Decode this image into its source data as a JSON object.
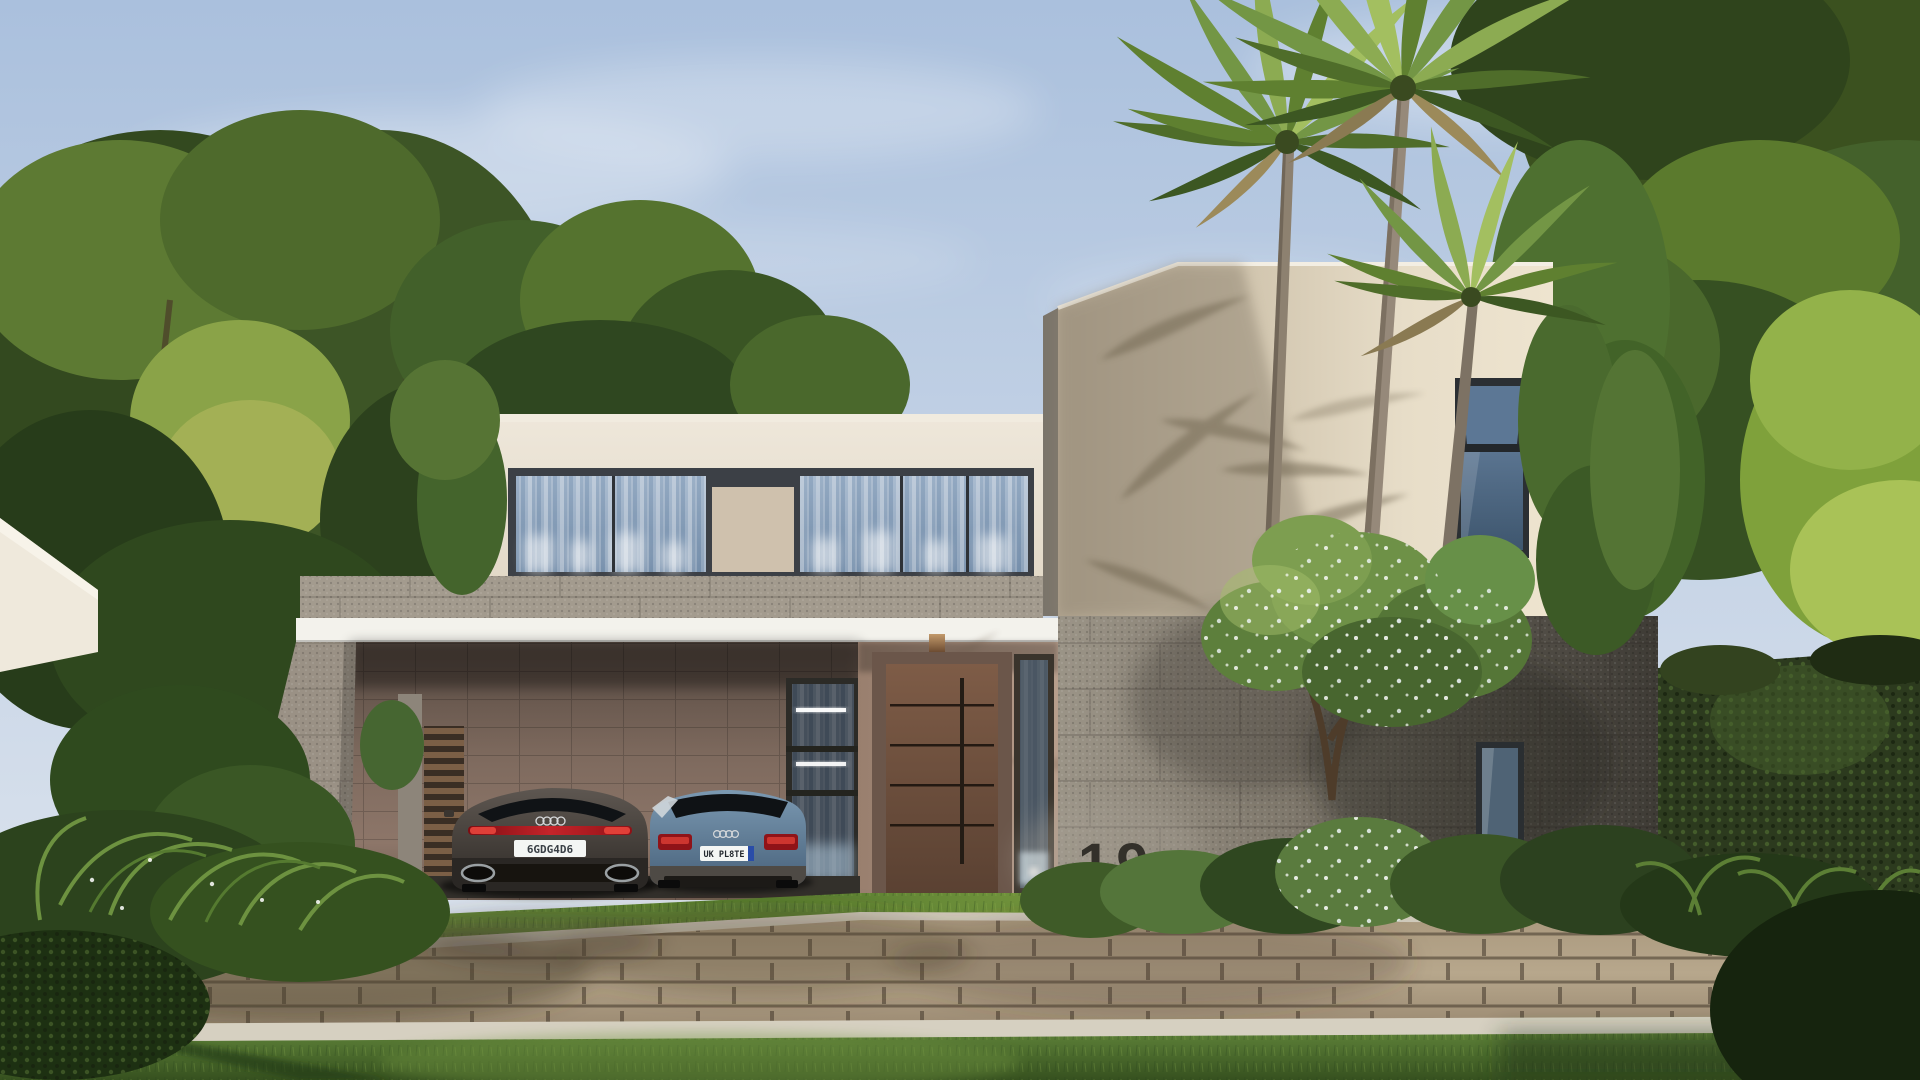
{
  "scene": {
    "setting": "Photorealistic exterior rendering of a modern two-storey villa with carport, palm trees and landscaped front yard",
    "elements": [
      "sky",
      "clouds",
      "background-trees",
      "neighbor-wall",
      "villa-upper-floor",
      "tower-volume",
      "white-fascia",
      "carport",
      "front-door",
      "entry-wall",
      "stone-wall",
      "house-number",
      "palm-trees",
      "flowering-tree",
      "ivy-boundary-wall",
      "shrubs",
      "ferns",
      "grass-strip",
      "paver-driveway",
      "curb",
      "front-lawn",
      "two-parked-cars"
    ]
  },
  "house": {
    "number": "19"
  },
  "vehicles": {
    "sedan": {
      "name": "dark grey fastback sedan",
      "plate": "6GDG4D6",
      "logo": "audi-rings-icon"
    },
    "suv": {
      "name": "steel blue compact SUV",
      "plate": "UK PL8TE",
      "logo": "audi-rings-icon"
    }
  },
  "palette": {
    "sky_top": "#aac0dd",
    "sky_horizon": "#e2e8f0",
    "wall_cream": "#e9e1d3",
    "tower_lit": "#eee4cf",
    "tower_shade": "#b3a691",
    "fascia_white": "#f3f2ec",
    "stone_band": "#a39b8e",
    "stone_wall_dark": "#3e3b35",
    "carport_wall": "#8d7669",
    "door_brown": "#6e5241",
    "glass_blue": "#7f98b4",
    "curtain_white": "#ffffff",
    "foliage_dark": "#2d431f",
    "foliage_light": "#7d9c4a",
    "lawn_green": "#5d8038",
    "paver_tan": "#b7a78c",
    "curb_light": "#d6d0c1",
    "taillight_red": "#c5242a",
    "plate_white": "#f4f6f4",
    "house_number_color": "#33302a"
  }
}
